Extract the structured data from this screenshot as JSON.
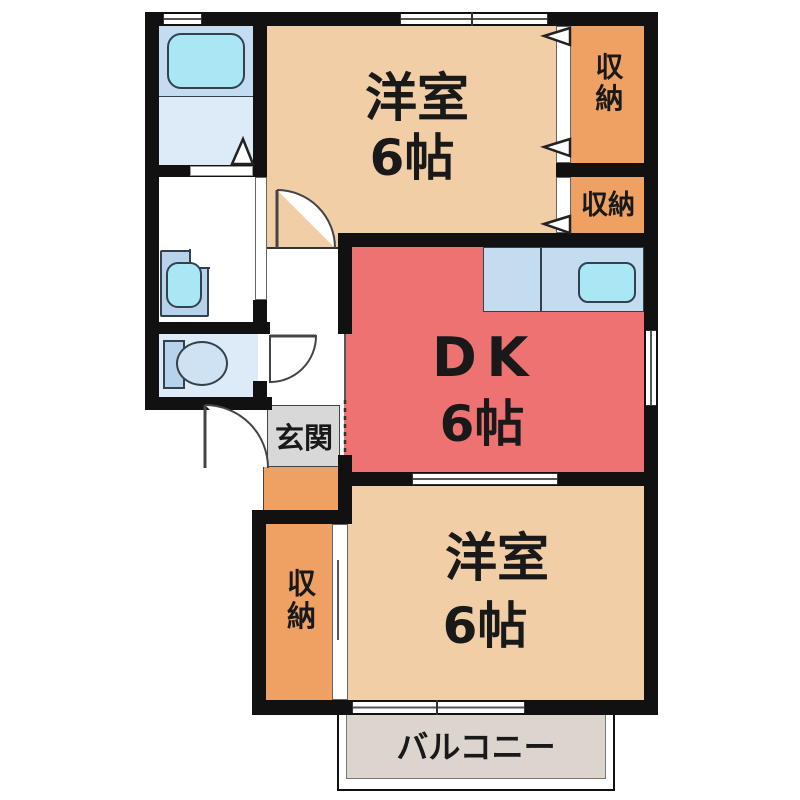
{
  "plan": {
    "rooms": {
      "western_top": {
        "name": "洋室",
        "size": "6帖"
      },
      "dk": {
        "name": "DK",
        "size": "6帖"
      },
      "western_bottom": {
        "name": "洋室",
        "size": "6帖"
      },
      "storage_top": {
        "name": "収納"
      },
      "storage_mid": {
        "name": "収納"
      },
      "storage_bottom": {
        "name": "収納"
      },
      "entrance": {
        "name": "玄関"
      },
      "balcony": {
        "name": "バルコニー"
      }
    },
    "fixtures": {
      "bathtub": "bathtub",
      "washbasin": "washbasin",
      "toilet": "toilet",
      "kitchen_sink": "kitchen-sink"
    },
    "colors": {
      "wall": "#111111",
      "western_room": "#f2cea6",
      "storage": "#efa163",
      "dining_kitchen": "#ee7272",
      "bathroom": "#dcebf7",
      "bathroom_wet": "#c3dcf0",
      "fixture_water": "#a9e7f5",
      "entrance_floor": "#d8d8d8",
      "balcony_floor": "#dcd5ce"
    }
  }
}
